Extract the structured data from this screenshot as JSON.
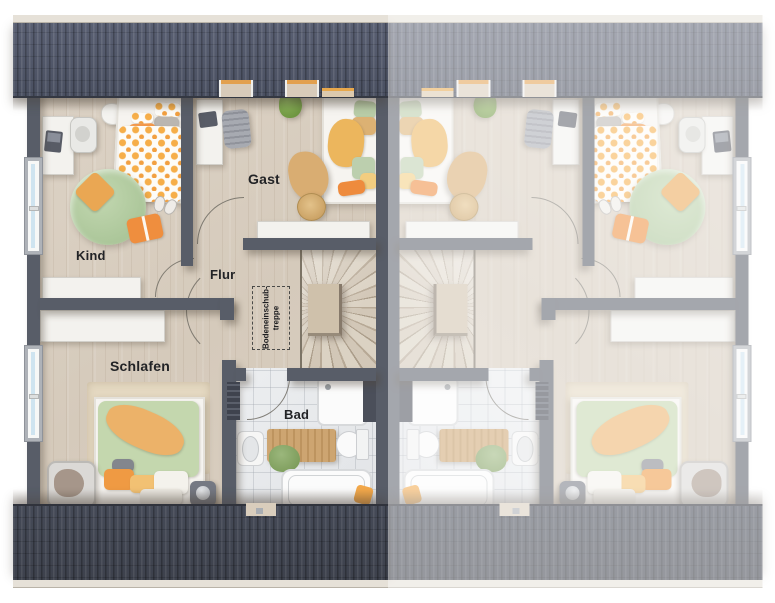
{
  "rooms": {
    "kind": {
      "label": "Kind"
    },
    "gast": {
      "label": "Gast"
    },
    "flur": {
      "label": "Flur"
    },
    "schlafen": {
      "label": "Schlafen"
    },
    "bad": {
      "label": "Bad"
    }
  },
  "stair_note": {
    "line1": "Bodeneinschub-",
    "line2": "treppe"
  },
  "colors": {
    "roof_top": "#545a6a",
    "roof_bottom": "#41454f",
    "wall": "#585d68",
    "floor_wood": "#d9cec1",
    "bath_tile": "#e7e9ea",
    "accent_orange": "#f0954a",
    "accent_green": "#b9cfa6",
    "window_glass": "#cfe4f0",
    "fade_overlay": "rgba(255,255,255,0.46)"
  }
}
